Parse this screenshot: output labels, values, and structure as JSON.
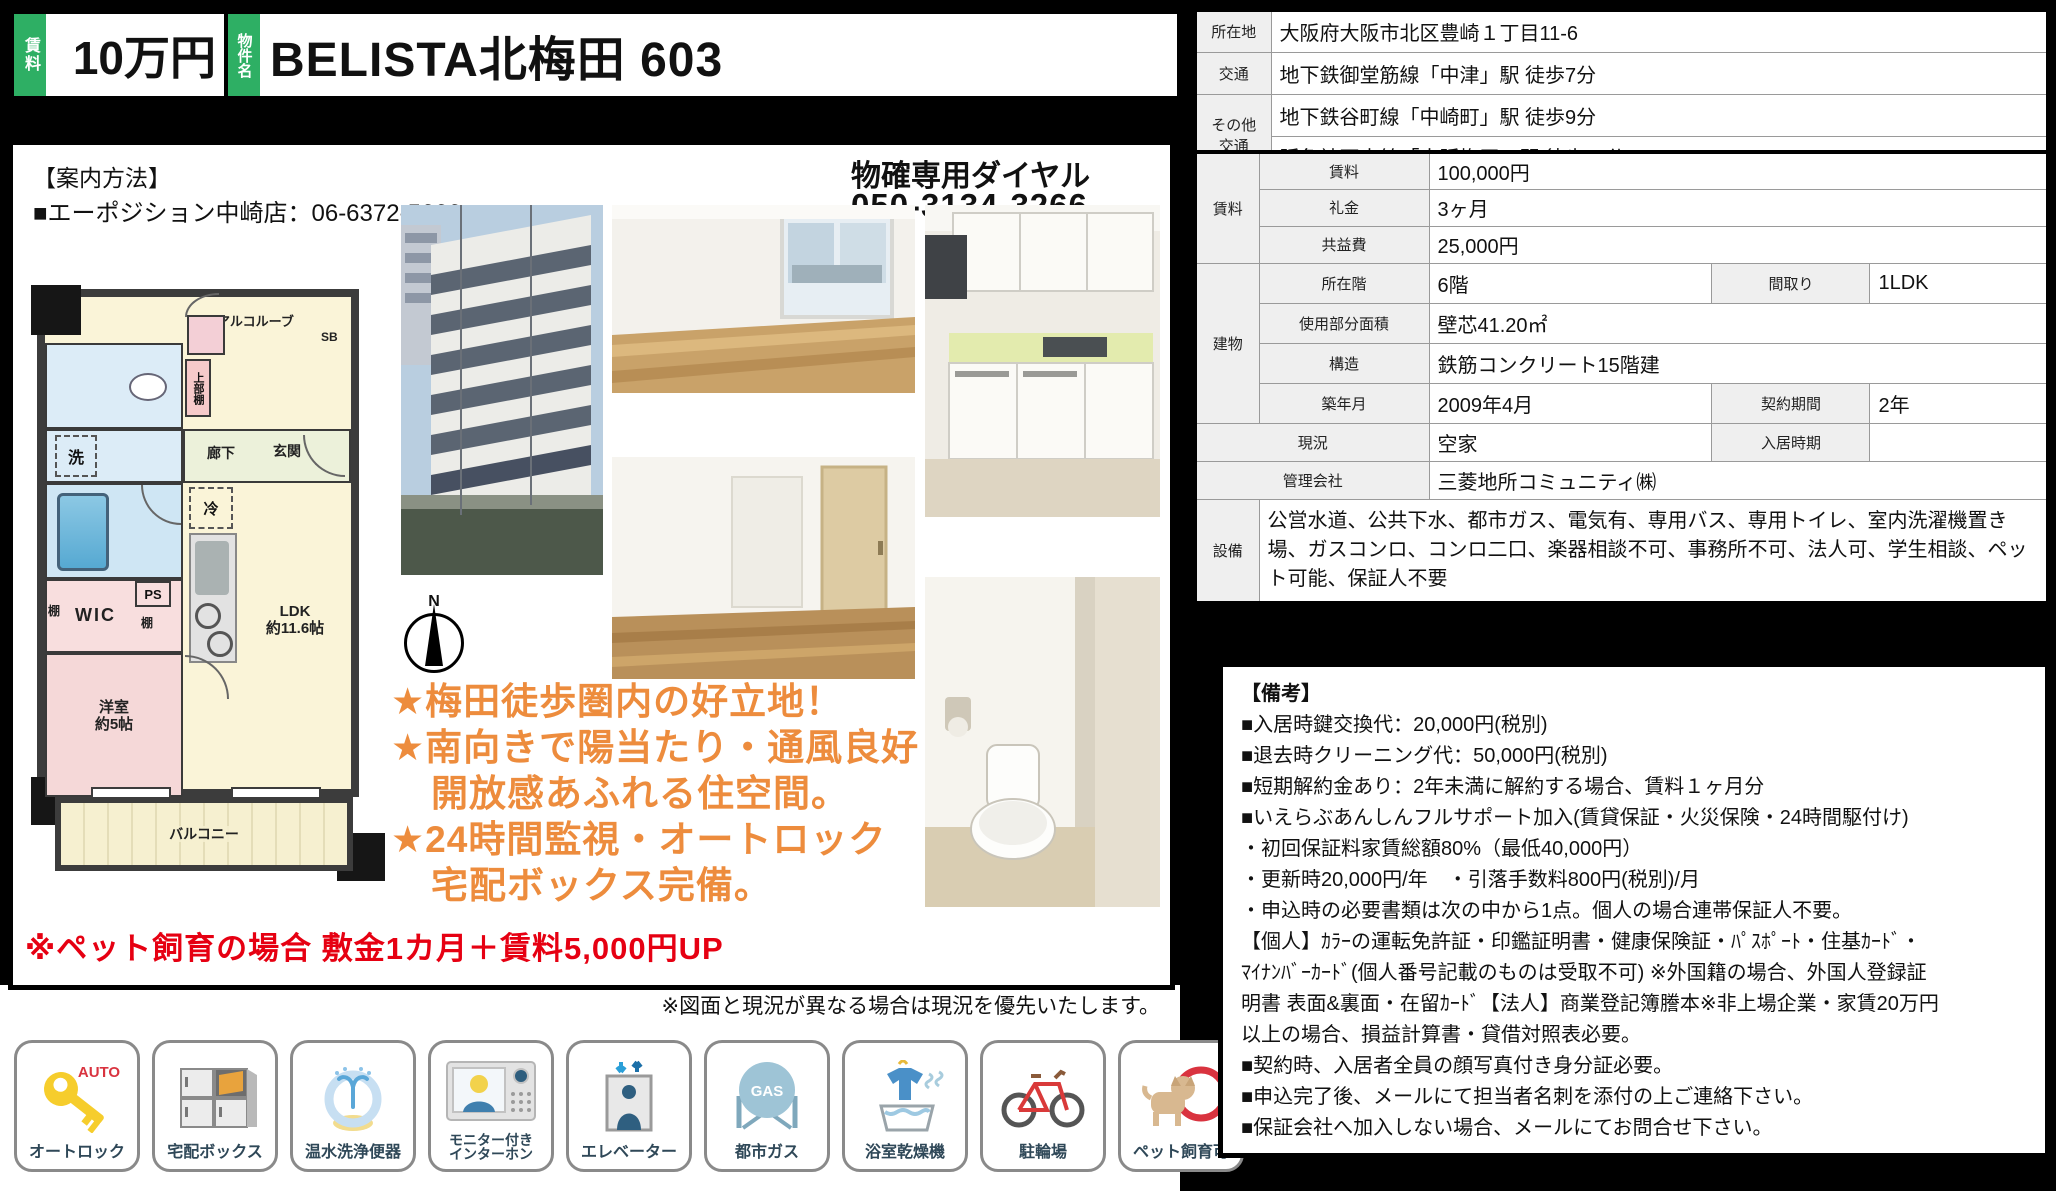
{
  "header": {
    "rent_label": "賃料",
    "rent_value": "10万円",
    "name_label": "物件名",
    "name_value": "BELISTA北梅田 603"
  },
  "guide": {
    "title": "【案内方法】",
    "agent_line": "■エーポジション中崎店：06-6372-5666",
    "dial_label": "物確専用ダイヤル",
    "dial_number": "050-3134-3266"
  },
  "floorplan": {
    "compass_n": "N",
    "labels": {
      "alcove": "アルコルーブ",
      "sb": "SB",
      "upper_shelf": "上部棚",
      "laundry": "洗",
      "hallway": "廊下",
      "entrance": "玄関",
      "fridge": "冷",
      "shelf_left": "棚",
      "wic": "WIC",
      "shelf_right": "棚",
      "ps": "PS",
      "ldk": "LDK\n約11.6帖",
      "bedroom": "洋室\n約5帖",
      "balcony": "バルコニー"
    }
  },
  "highlights": {
    "line1": "★梅田徒歩圏内の好立地！",
    "line2": "★南向きで陽当たり・通風良好",
    "line3": "開放感あふれる住空間。",
    "line4": "★24時間監視・オートロック",
    "line5": "宅配ボックス完備。"
  },
  "pet_note": "※ペット飼育の場合 敷金1カ月＋賃料5,000円UP",
  "disclaimer": "※図面と現況が異なる場合は現況を優先いたします。",
  "location_table": {
    "row1_label": "所在地",
    "row1_value": "大阪府大阪市北区豊崎１丁目11-6",
    "row2_label": "交通",
    "row2_value": "地下鉄御堂筋線「中津」駅 徒歩7分",
    "row34_label": "その他\n交通",
    "row3_value": "地下鉄谷町線「中崎町」駅 徒歩9分",
    "row4_value": "阪急神戸本線「大阪梅田」駅 徒歩11分"
  },
  "detail_table": {
    "rent_group": "賃料",
    "rent_label": "賃料",
    "rent_value": "100,000円",
    "key_label": "礼金",
    "key_value": "3ヶ月",
    "fee_label": "共益費",
    "fee_value": "25,000円",
    "building_group": "建物",
    "floor_label": "所在階",
    "floor_value": "6階",
    "madori_label": "間取り",
    "madori_value": "1LDK",
    "area_label": "使用部分面積",
    "area_value": "壁芯41.20㎡",
    "structure_label": "構造",
    "structure_value": "鉄筋コンクリート15階建",
    "built_label": "築年月",
    "built_value": "2009年4月",
    "term_label": "契約期間",
    "term_value": "2年",
    "status_label": "現況",
    "status_value": "空家",
    "movein_label": "入居時期",
    "movein_value": "",
    "mgmt_label": "管理会社",
    "mgmt_value": "三菱地所コミュニティ㈱",
    "equip_label": "設備",
    "equip_value": "公営水道、公共下水、都市ガス、電気有、専用バス、専用トイレ、室内洗濯機置き場、ガスコンロ、コンロ二口、楽器相談不可、事務所不可、法人可、学生相談、ペット可能、保証人不要"
  },
  "remarks": {
    "title": "【備考】",
    "lines": [
      "■入居時鍵交換代：20,000円(税別)",
      "■退去時クリーニング代：50,000円(税別)",
      "■短期解約金あり：2年未満に解約する場合、賃料１ヶ月分",
      "■いえらぶあんしんフルサポート加入(賃貸保証・火災保険・24時間駆付け)",
      "・初回保証料家賃総額80%（最低40,000円）",
      "・更新時20,000円/年　・引落手数料800円(税別)/月",
      "・申込時の必要書類は次の中から1点。個人の場合連帯保証人不要。",
      "【個人】ｶﾗｰの運転免許証・印鑑証明書・健康保険証・ﾊﾟｽﾎﾟｰﾄ・住基ｶｰﾄﾞ・",
      "ﾏｲﾅﾝﾊﾞｰｶｰﾄﾞ(個人番号記載のものは受取不可) ※外国籍の場合、外国人登録証",
      "明書 表面&裏面・在留ｶｰﾄﾞ【法人】商業登記簿謄本※非上場企業・家賃20万円",
      "以上の場合、損益計算書・貸借対照表必要。",
      "■契約時、入居者全員の顔写真付き身分証必要。",
      "■申込完了後、メールにて担当者名刺を添付の上ご連絡下さい。",
      "■保証会社へ加入しない場合、メールにてお問合せ下さい。"
    ]
  },
  "amenities": [
    {
      "label": "オートロック"
    },
    {
      "label": "宅配ボックス"
    },
    {
      "label": "温水洗浄便器"
    },
    {
      "label": "モニター付き\nインターホン"
    },
    {
      "label": "エレベーター"
    },
    {
      "label": "都市ガス"
    },
    {
      "label": "浴室乾燥機"
    },
    {
      "label": "駐輪場"
    },
    {
      "label": "ペット飼育可"
    }
  ],
  "colors": {
    "accent_green": "#2EAF64",
    "highlight_orange": "#ED8C3D",
    "alert_red": "#E60012"
  }
}
